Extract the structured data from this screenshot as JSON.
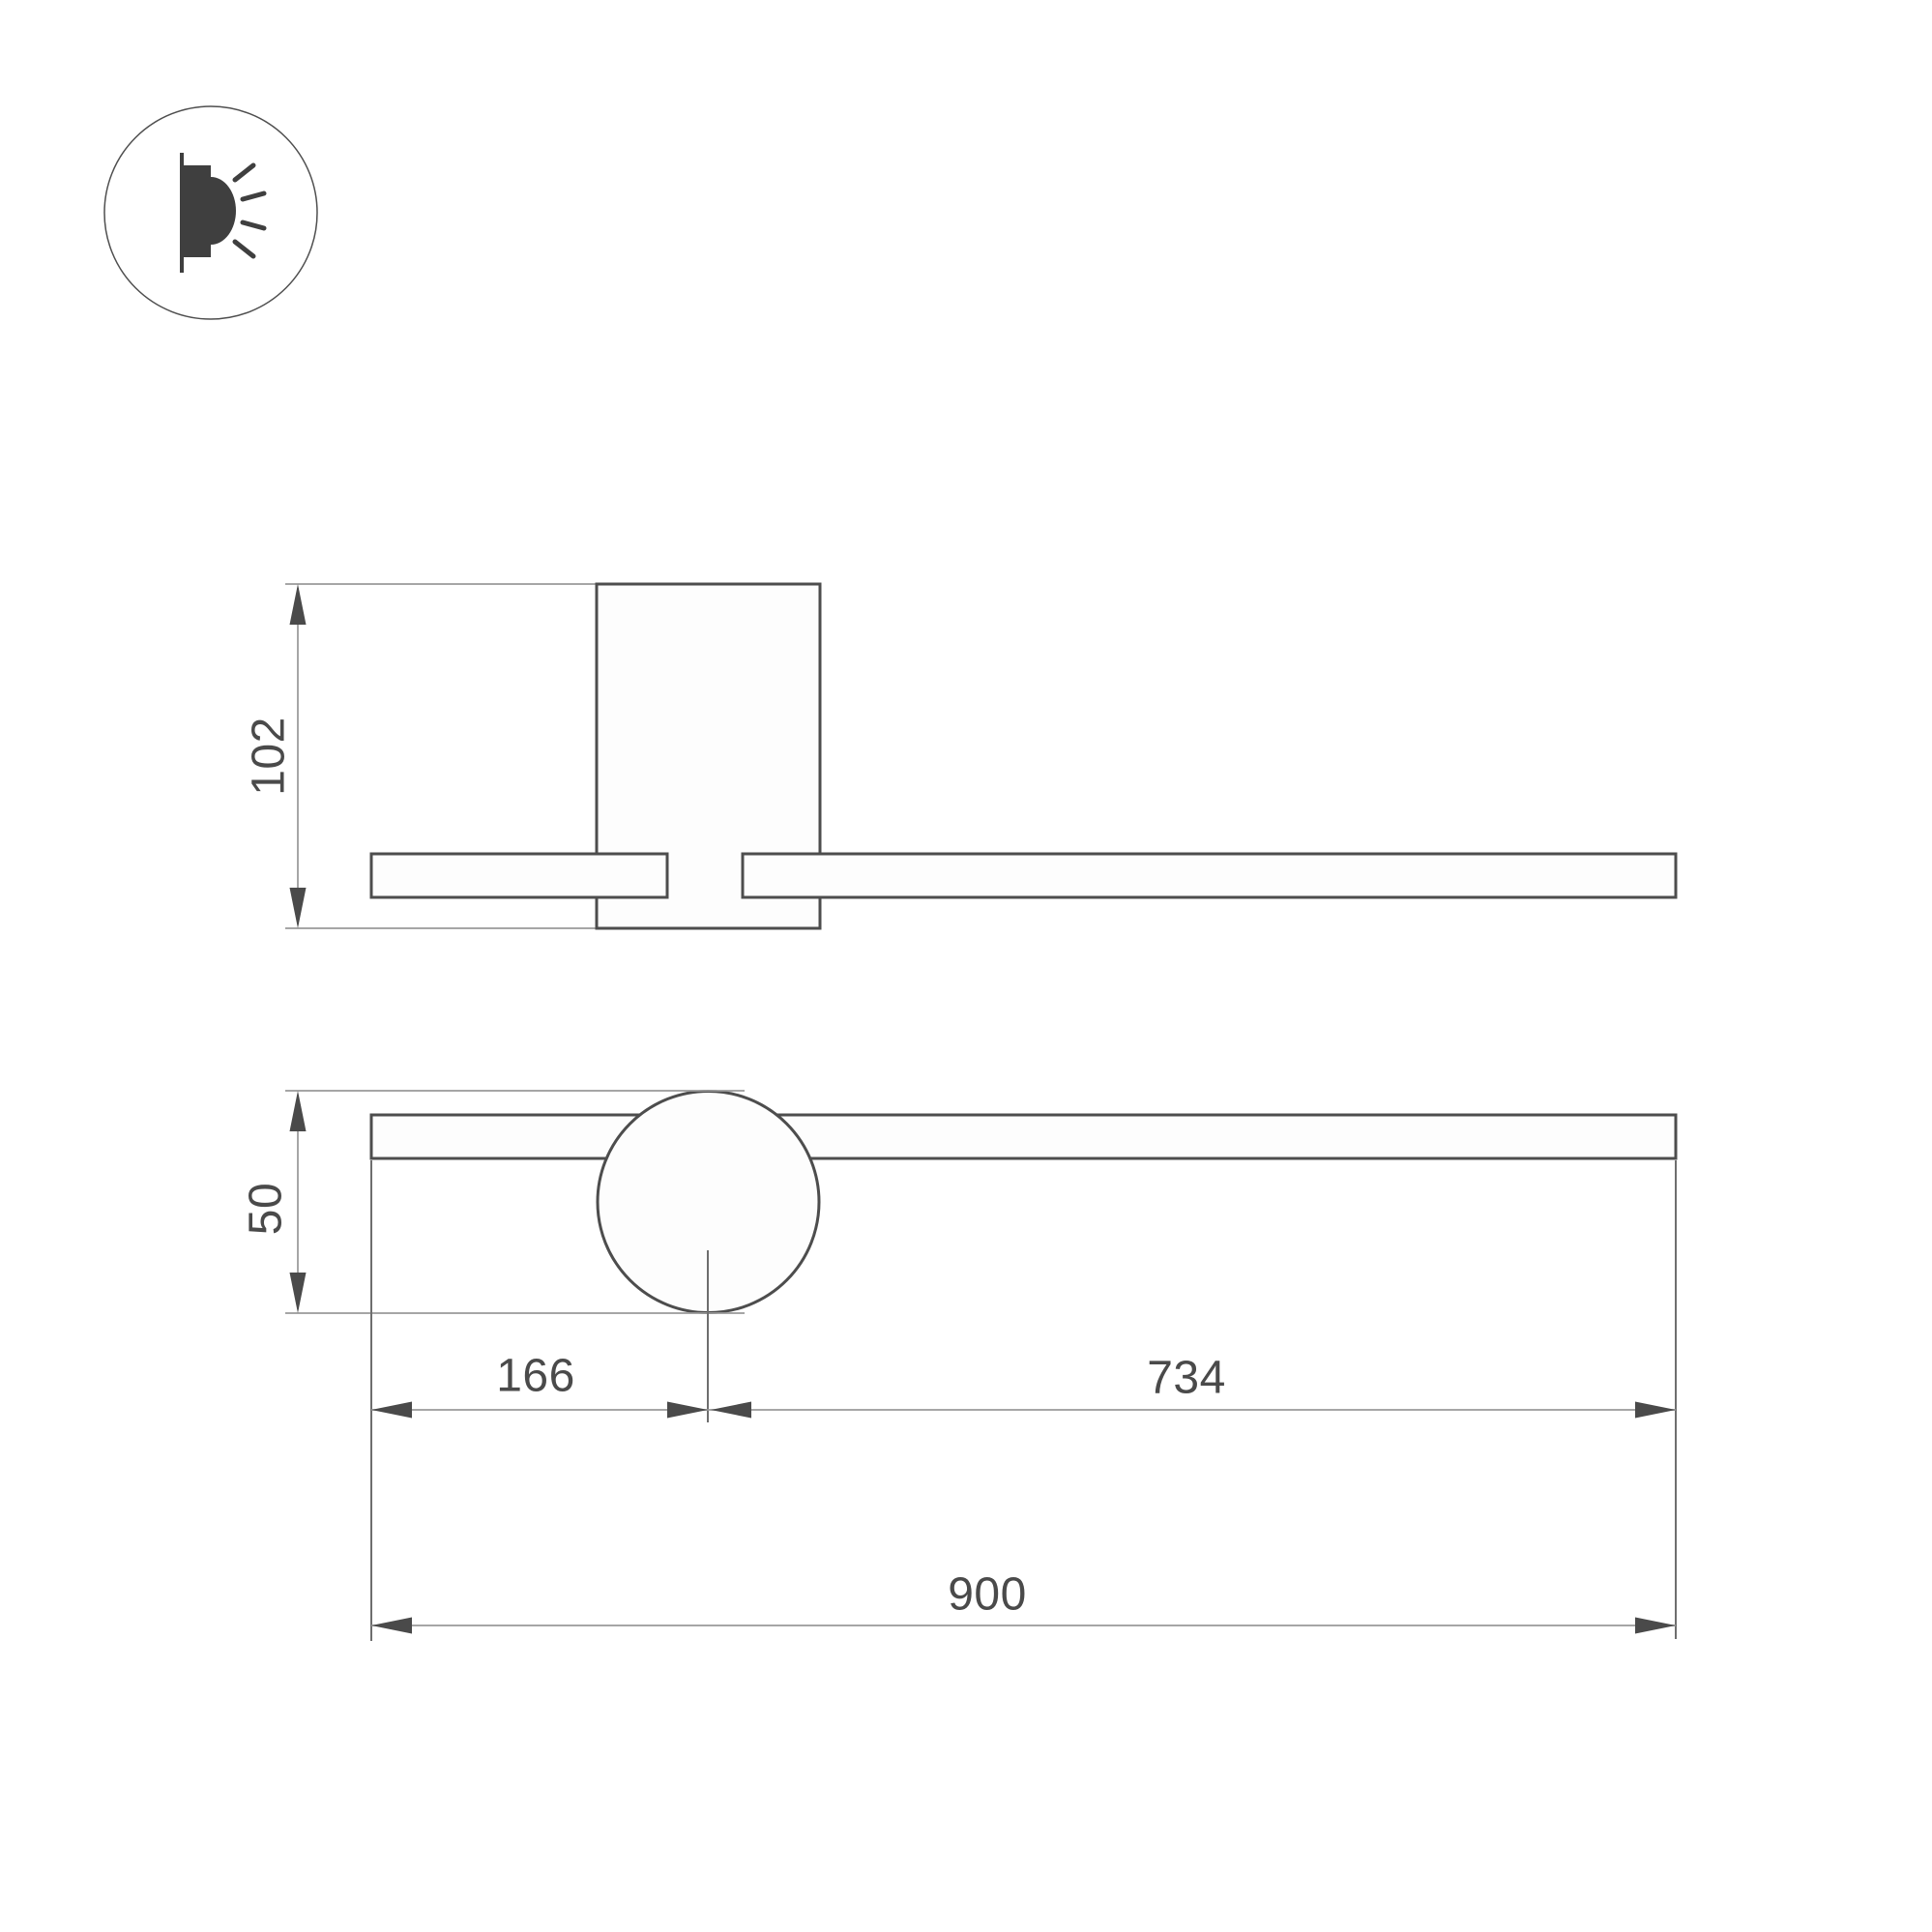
{
  "drawing": {
    "type": "technical-dimension-drawing",
    "product": "linear wall light with round head",
    "icon": {
      "name": "wall-mounted-light-direction",
      "description": "lamp on wall emitting light sideways"
    },
    "side_view": {
      "height_label": "102",
      "height_mm": 102
    },
    "front_view": {
      "head_diameter_label": "50",
      "head_diameter_mm": 50,
      "left_offset_label": "166",
      "left_offset_mm": 166,
      "right_span_label": "734",
      "right_span_mm": 734,
      "total_length_label": "900",
      "total_length_mm": 900
    },
    "colors": {
      "background": "#ffffff",
      "outline": "#4d4d4d",
      "dimension_lines": "#9a9a9a",
      "text": "#4a4a4a",
      "icon": "#3f3f3f"
    }
  }
}
